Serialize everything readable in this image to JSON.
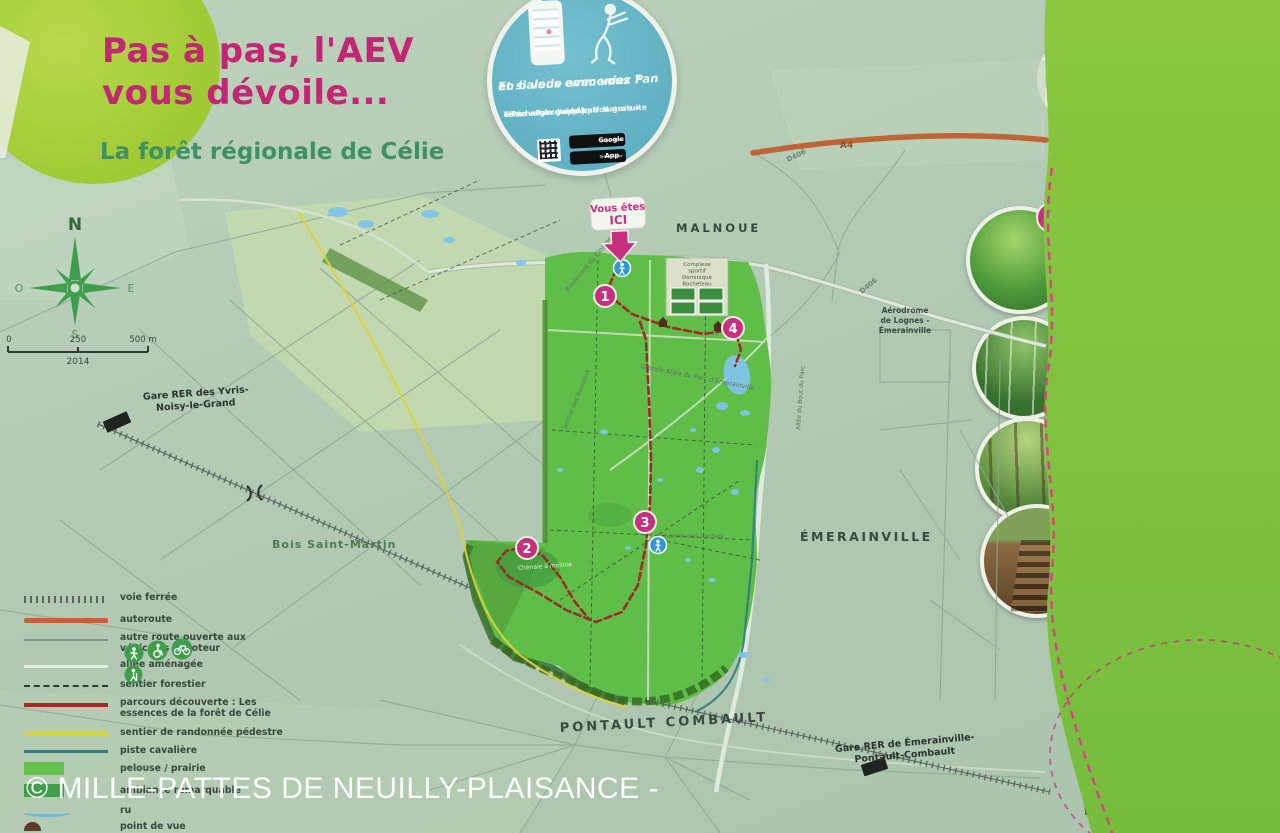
{
  "header": {
    "title_line1": "Pas à pas, l'AEV",
    "title_line2": "vous dévoile...",
    "subtitle": "La forêt régionale de Célie"
  },
  "app_sticker": {
    "heading_line1": "Et si vous emmeniez Pan",
    "heading_line2": "en balade avec vous ?",
    "body_line1": "Téléchargez l'application gratuite",
    "body_line2": "« Pan - Parcours Appli' Nature »",
    "body_line3": "et suivez le guide !",
    "google_play_small": "Disponible sur",
    "google_play": "Google play",
    "app_store_small": "Télécharger sur",
    "app_store": "App Store"
  },
  "essences_panel": {
    "title_line1": "Les essences de",
    "title_line2": "la forêt de Célie",
    "items": [
      {
        "num": "1",
        "title": "Saules têtards",
        "text": "La végétation des berges du petit ru est régulièrement entretenue afin de ne pas gêner l'écoulement de l'eau. Certains arbres, tels les Saules, sont coupés à environ 1,5 m du sol. La cicatrice forme une boule dont partent des branches qui sont sectionnées tous les ans. Ces Saules « têtards » constituent un micro habitat très favorable aux insectes."
      },
      {
        "num": "2",
        "title": "Chênaie à molinie",
        "text": "Située sur une partie ancienne de la forêt, au sol humide et acide, ce boisement est essentiellement constitué de Chênes pédonculés et de Bouleaux. Au sol, pousse la Molinie, herbe vivace qui se développe principalement dans les milieux humides."
      },
      {
        "num": "3",
        "title": "Futaie de chênes",
        "text": "Il s'agit d'une parcelle peuplée de chênes de diamètres imposants tous issus de graines (glands) d'où le terme de futaie. Le sous-bois, peu dense, laisse pénétrer le regard au loin."
      },
      {
        "num": "4",
        "title": "Butte de Célie",
        "text": "Deux buttes ont été créées pour stocker de la terre à l'extrémité sud du terrain de sport. L'une d'elles a été aménagée par l'AEV et rendue accessible pour constituer un promontoire à la hauteur de la cime des arbres, offrant une vue dominante sur la forêt et les étangs proches."
      }
    ]
  },
  "trail_info": {
    "intro_line1": "Ce parcours découverte, proposé par",
    "intro_line2": "l'Agence des espaces verts, est balisé en rose.",
    "marker_ok": "Vous êtes sur le bon chemin",
    "marker_turn": "Dirigez-vous vers la gauche ou la droite",
    "marker_wrong": "Vous êtes dans la mauvaise direction",
    "distance": "Distance à parcourir : 4,7 km",
    "duration": "Durée de la boucle estimée à 1 h 15",
    "more_line1": "Plus de parcours sur",
    "more_line2": "www.aev-iledefrance.fr"
  },
  "legend": {
    "items": [
      "voie ferrée",
      "autoroute",
      "autre route ouverte aux véhicules à moteur",
      "allée aménagée",
      "sentier forestier",
      "parcours découverte : Les essences de la forêt de Célie",
      "sentier de randonnée pédestre",
      "piste cavalière",
      "pelouse / prairie",
      "ambiance remarquable",
      "ru",
      "point de vue"
    ]
  },
  "map": {
    "you_are_here_l1": "Vous êtes",
    "you_are_here_l2": "ICI",
    "markers": [
      "1",
      "2",
      "3",
      "4"
    ],
    "labels": {
      "malnoue": "MALNOUE",
      "emerainville": "ÉMERAINVILLE",
      "pontault": "PONTAULT COMBAULT",
      "bois_saint_martin": "Bois Saint-Martin",
      "gare_yvris_l1": "Gare RER des Yvris-",
      "gare_yvris_l2": "Noisy-le-Grand",
      "gare_emer_l1": "Gare RER de Émerainville-",
      "gare_emer_l2": "Pontault-Combault",
      "aerodrome_l1": "Aérodrome",
      "aerodrome_l2": "de Lognes -",
      "aerodrome_l3": "Émerainville",
      "complexe_l1": "Complexe",
      "complexe_l2": "sportif",
      "complexe_l3": "Dominique",
      "complexe_l4": "Rocheteau",
      "chemin_vaches": "Chemin des Vaches",
      "bd_clos": "Boulevard du Clos de l'Aumône",
      "grande_allee": "Grande Allée du Parc d'Émerainville",
      "sentier_bouleaux": "Sentier des Bouleaux",
      "allee_bout": "Allée du Bout du Parc",
      "chenaie": "Chênaie à molinie",
      "a4": "A4",
      "d406": "D406"
    },
    "compass": {
      "n": "N",
      "s": "S",
      "e": "E",
      "o": "O"
    },
    "scale": {
      "t0": "0",
      "t250": "250",
      "t500": "500 m",
      "year": "2014"
    }
  },
  "watermark": "© MILLE-PATTES DE NEUILLY-PLAISANCE -",
  "colors": {
    "magenta": "#c5317e",
    "trail_red": "#9e2b25",
    "panel_green": "#82c341",
    "forest_green": "#5fbe48",
    "sticker_blue": "#64b5c6",
    "text_red": "#a03c1e"
  }
}
